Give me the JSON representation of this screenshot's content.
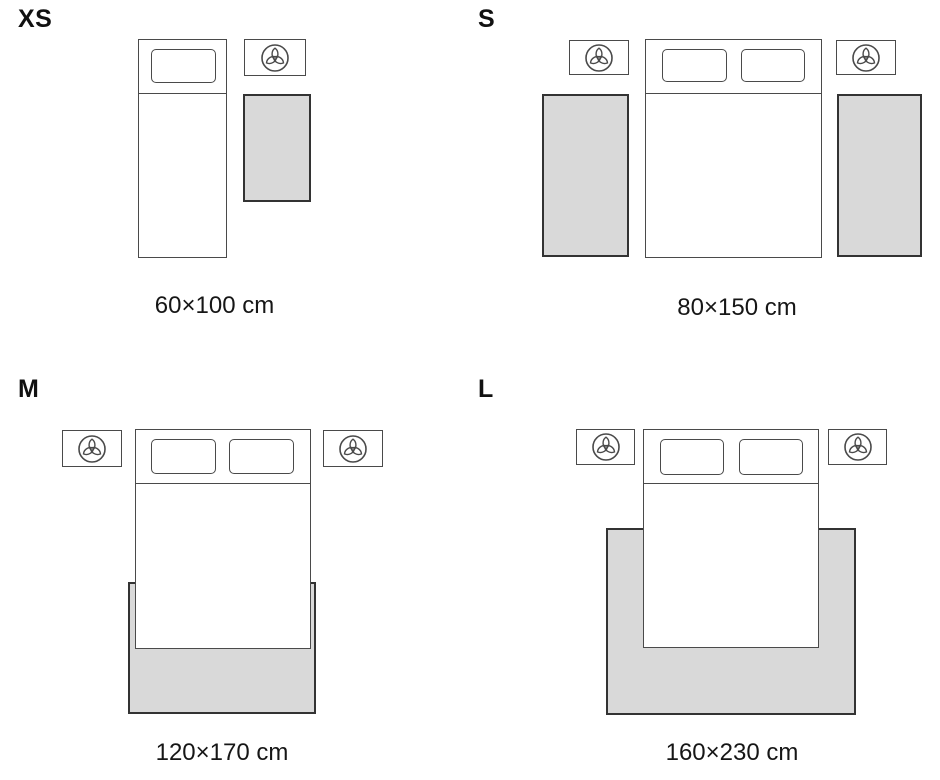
{
  "colors": {
    "background": "#ffffff",
    "outline": "#4a4a4a",
    "rug_fill": "#d9d9d9",
    "rug_outline": "#333333",
    "text": "#161616"
  },
  "icons": {
    "nightstand_decor": "trefoil-plant-icon"
  },
  "sizes": [
    {
      "id": "xs",
      "label": "XS",
      "dimensions": "60×100 cm"
    },
    {
      "id": "s",
      "label": "S",
      "dimensions": "80×150 cm"
    },
    {
      "id": "m",
      "label": "M",
      "dimensions": "120×170 cm"
    },
    {
      "id": "l",
      "label": "L",
      "dimensions": "160×230 cm"
    }
  ]
}
